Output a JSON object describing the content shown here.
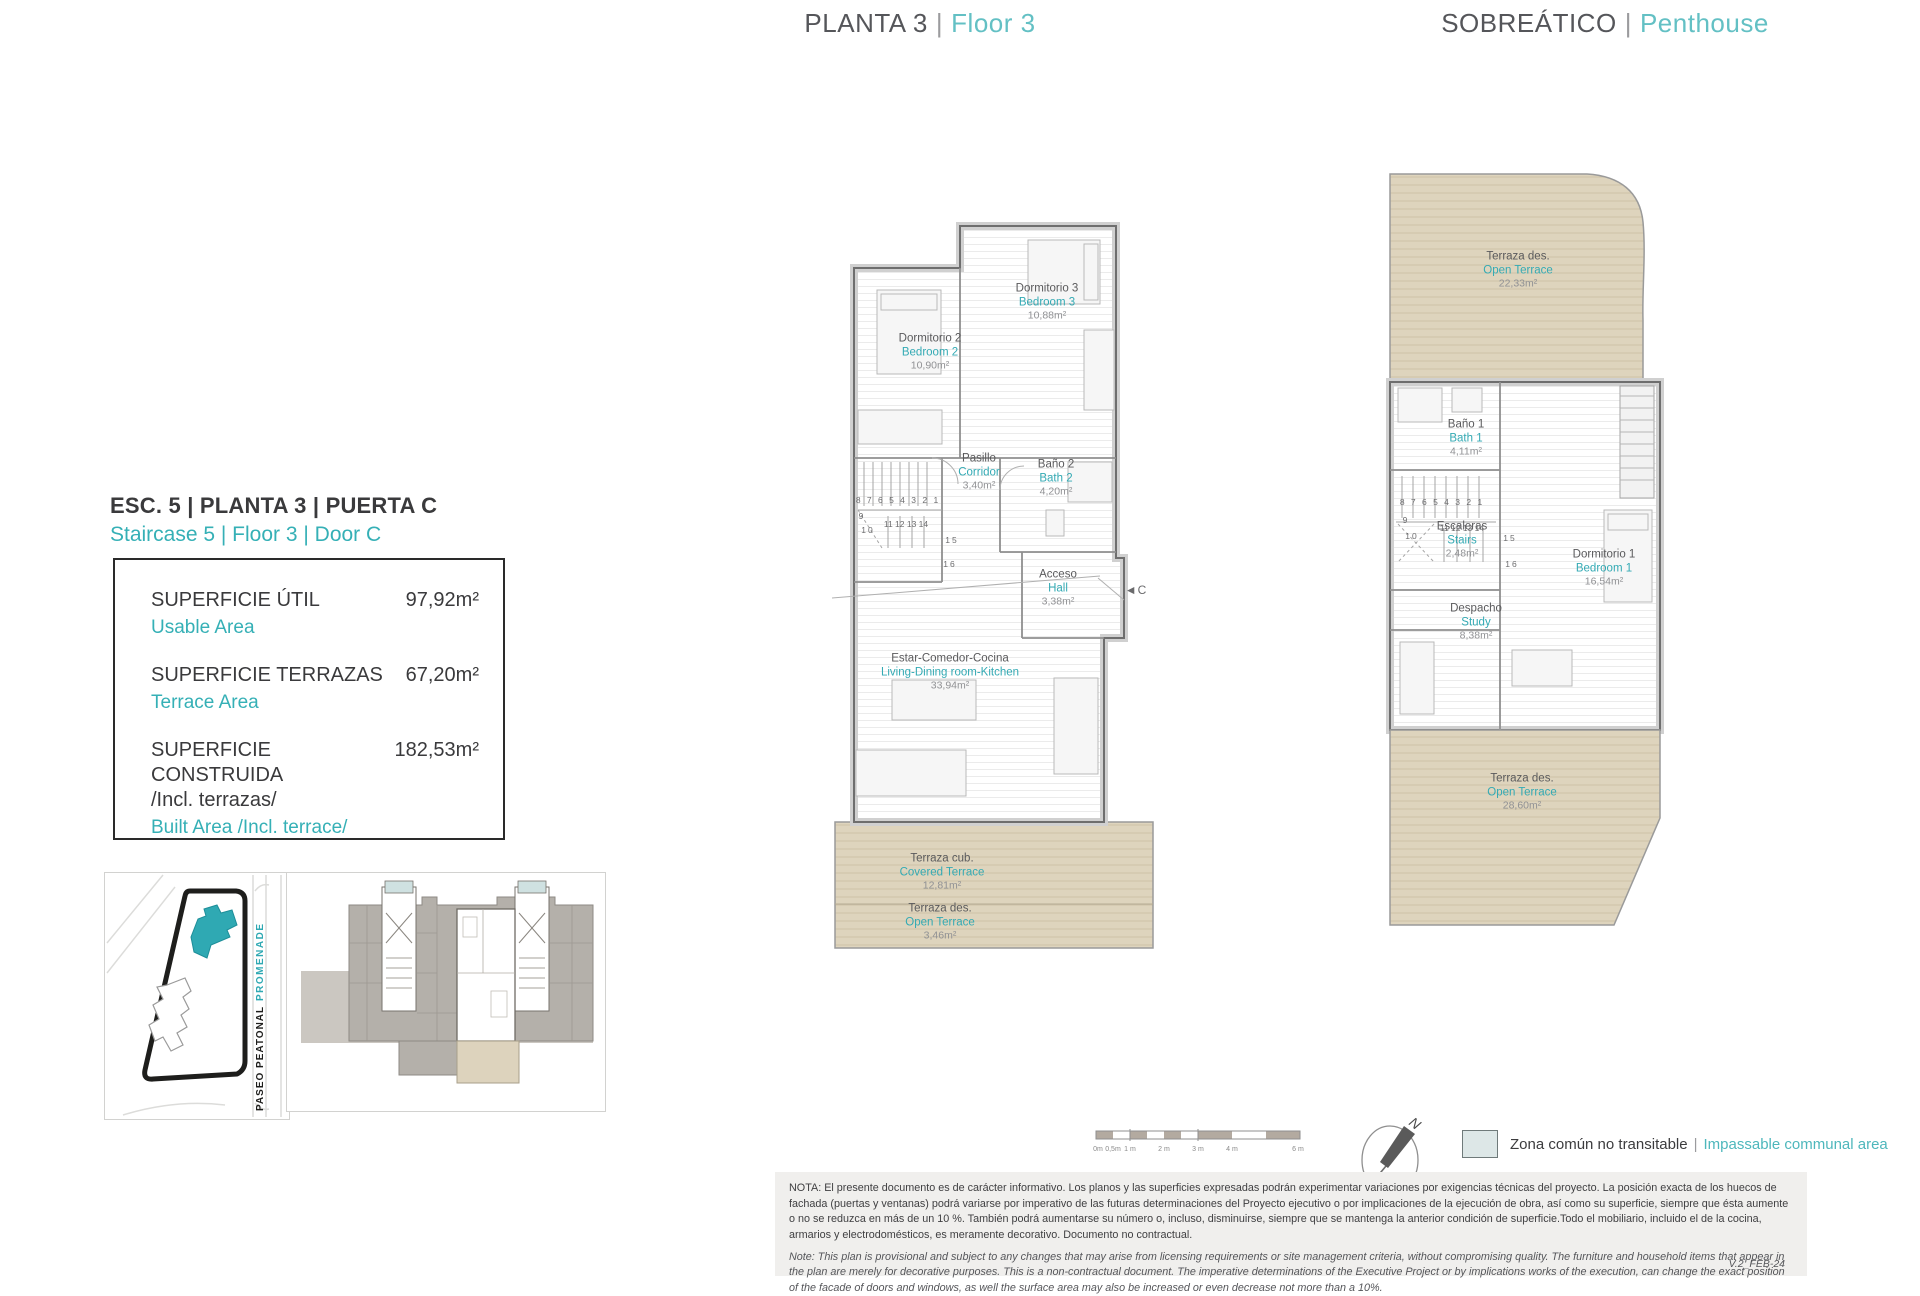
{
  "colors": {
    "teal": "#35b0b6",
    "teal_light": "#63c0c4",
    "dark_text": "#3a3a3c",
    "deck_beige": "#ded4bd",
    "site_building_teal": "#2fa9b3"
  },
  "header": {
    "separator": "|",
    "center_es": "PLANTA 3",
    "center_en": "Floor 3",
    "right_es": "SOBREÁTICO",
    "right_en": "Penthouse"
  },
  "unit": {
    "title_es": "ESC. 5 | PLANTA 3 | PUERTA C",
    "title_en": "Staircase 5 | Floor 3 | Door C"
  },
  "areas_box": {
    "rows": [
      {
        "label_es": "SUPERFICIE ÚTIL",
        "label_en": "Usable Area",
        "value": "97,92m²"
      },
      {
        "label_es": "SUPERFICIE TERRAZAS",
        "label_en": "Terrace Area",
        "value": "67,20m²"
      },
      {
        "label_es": "SUPERFICIE CONSTRUIDA",
        "label_es2": "/Incl. terrazas/",
        "label_en": "Built Area /Incl. terrace/",
        "value": "182,53m²"
      }
    ]
  },
  "site_plan": {
    "street_top": "PROMENADE",
    "street_bottom": "PASEO PEATONAL"
  },
  "floor3": {
    "access_marker": "◄C",
    "rooms": {
      "bedroom2": {
        "es": "Dormitorio 2",
        "en": "Bedroom 2",
        "area": "10,90m²"
      },
      "bedroom3": {
        "es": "Dormitorio 3",
        "en": "Bedroom 3",
        "area": "10,88m²"
      },
      "corridor": {
        "es": "Pasillo",
        "en": "Corridor",
        "area": "3,40m²"
      },
      "bath2": {
        "es": "Baño 2",
        "en": "Bath 2",
        "area": "4,20m²"
      },
      "hall": {
        "es": "Acceso",
        "en": "Hall",
        "area": "3,38m²"
      },
      "living": {
        "es": "Estar-Comedor-Cocina",
        "en": "Living-Dining room-Kitchen",
        "area": "33,94m²"
      },
      "covered_terrace": {
        "es": "Terraza cub.",
        "en": "Covered Terrace",
        "area": "12,81m²"
      },
      "open_terrace": {
        "es": "Terraza des.",
        "en": "Open Terrace",
        "area": "3,46m²"
      }
    }
  },
  "penthouse": {
    "rooms": {
      "terrace_top": {
        "es": "Terraza des.",
        "en": "Open Terrace",
        "area": "22,33m²"
      },
      "bath1": {
        "es": "Baño 1",
        "en": "Bath 1",
        "area": "4,11m²"
      },
      "stairs": {
        "es": "Escaleras",
        "en": "Stairs",
        "area": "2,48m²"
      },
      "bedroom1": {
        "es": "Dormitorio 1",
        "en": "Bedroom 1",
        "area": "16,54m²"
      },
      "study": {
        "es": "Despacho",
        "en": "Study",
        "area": "8,38m²"
      },
      "terrace_bottom": {
        "es": "Terraza des.",
        "en": "Open Terrace",
        "area": "28,60m²"
      }
    }
  },
  "stair_numbers": {
    "top_row": "8 7 6 5 4 3 2 1",
    "left1": "9",
    "left2": "10",
    "mid_row": "11 12 13 14",
    "right1": "15",
    "right2": "16"
  },
  "scale_bar": {
    "labels": [
      "0m",
      "0,5m",
      "1 m",
      "2 m",
      "3 m",
      "4 m",
      "6 m"
    ]
  },
  "compass": {
    "north": "N"
  },
  "legend": {
    "separator": "|",
    "es": "Zona común no transitable",
    "en": "Impassable communal area"
  },
  "notes": {
    "nota_es": "NOTA:  El presente documento es de carácter informativo. Los planos y las superficies expresadas podrán experimentar variaciones por exigencias técnicas del proyecto. La posición exacta de los huecos de fachada (puertas y ventanas) podrá variarse por imperativo de las futuras determinaciones del Proyecto ejecutivo o por implicaciones de la ejecución de obra, así como su superficie, siempre que ésta aumente o no se reduzca en más de un 10 %. También podrá aumentarse su número o, incluso, disminuirse, siempre que se mantenga la anterior condición de superficie.Todo el mobiliario, incluido el de la cocina, armarios y electrodomésticos, es meramente decorativo. Documento no contractual.",
    "note_en": "Note: This plan is provisional and subject to any changes that may arise from licensing requirements or site management criteria, without compromising quality. The furniture and household items that appear in the plan are merely for decorative purposes. This is a non-contractual document. The imperative determinations of the Executive Project or by implications works of the execution, can change the exact position of the facade of doors and windows, as well the surface area may also be increased or even decrease not more than a 10%.",
    "version": "V.2_FEB-24"
  }
}
